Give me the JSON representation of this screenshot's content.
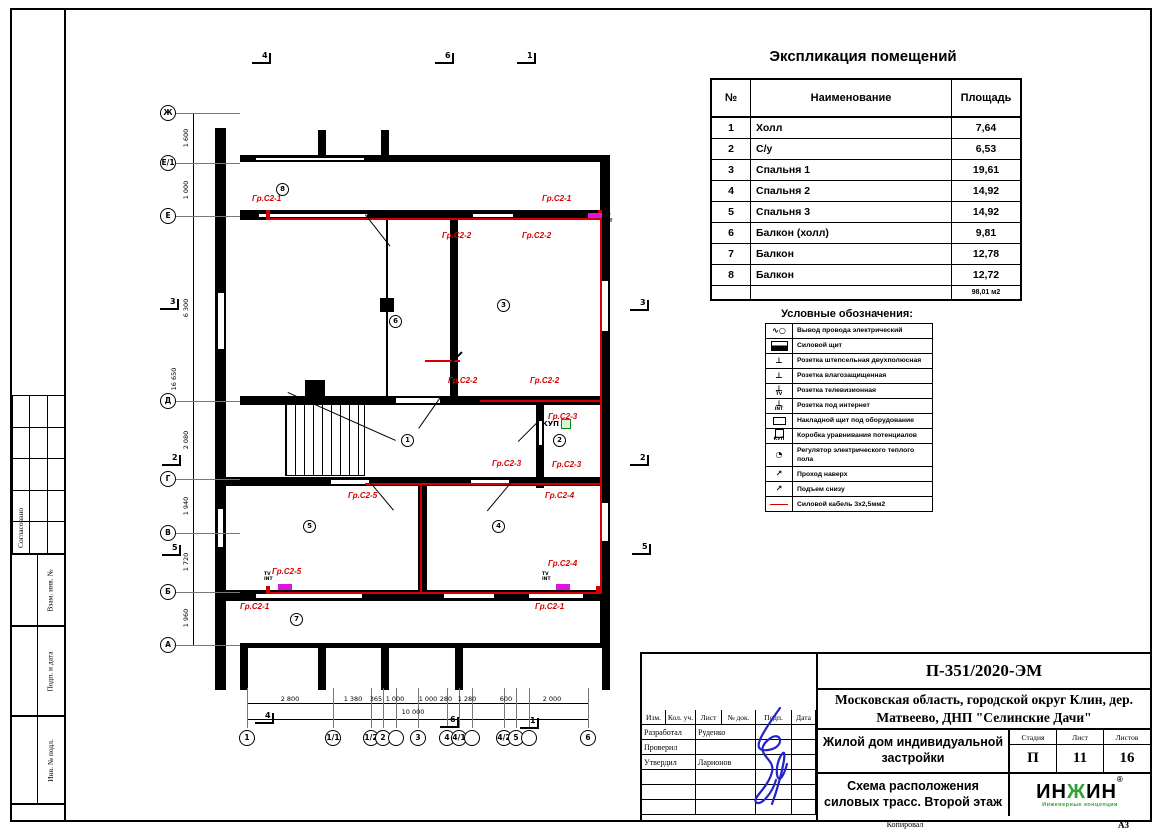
{
  "frame": {
    "copied": "Копировал",
    "format": "А3"
  },
  "left_margin": {
    "soglasovano": "Согласовано",
    "vzam": "Взам. инв. №",
    "podp_data": "Подп. и дата",
    "inv_podl": "Инв. № подл."
  },
  "explication": {
    "title": "Экспликация помещений",
    "columns": [
      "№",
      "Наименование",
      "Площадь"
    ],
    "rows": [
      [
        "1",
        "Холл",
        "7,64"
      ],
      [
        "2",
        "С/у",
        "6,53"
      ],
      [
        "3",
        "Спальня 1",
        "19,61"
      ],
      [
        "4",
        "Спальня 2",
        "14,92"
      ],
      [
        "5",
        "Спальня 3",
        "14,92"
      ],
      [
        "6",
        "Балкон (холл)",
        "9,81"
      ],
      [
        "7",
        "Балкон",
        "12,78"
      ],
      [
        "8",
        "Балкон",
        "12,72"
      ]
    ],
    "total": "98,01 м2"
  },
  "legend": {
    "title": "Условные обозначения:",
    "items": [
      {
        "icon": "wire-output-icon",
        "label": "Вывод провода электрический"
      },
      {
        "icon": "power-panel-icon",
        "label": "Силовой щит"
      },
      {
        "icon": "socket-double-icon",
        "label": "Розетка штепсельная двухполюсная"
      },
      {
        "icon": "socket-moisture-icon",
        "label": "Розетка влагозащищенная"
      },
      {
        "icon": "socket-tv-icon",
        "suffix": "TV",
        "label": "Розетка телевизионная"
      },
      {
        "icon": "socket-internet-icon",
        "suffix": "INT",
        "label": "Розетка под интернет"
      },
      {
        "icon": "surface-panel-icon",
        "label": "Накладной щит под оборудование"
      },
      {
        "icon": "kup-box-icon",
        "suffix": "КУП",
        "label": "Коробка уравнивания потенциалов"
      },
      {
        "icon": "floor-regulator-icon",
        "label": "Регулятор электрического теплого пола"
      },
      {
        "icon": "pass-up-icon",
        "label": "Проход наверх"
      },
      {
        "icon": "rise-below-icon",
        "label": "Подъем снизу"
      },
      {
        "icon": "power-cable-icon",
        "label": "Силовой кабель 3х2,5мм2"
      }
    ]
  },
  "titleblock": {
    "doc_number": "П-351/2020-ЭМ",
    "address": "Московская область, городской округ Клин, дер. Матвеево, ДНП \"Селинские Дачи\"",
    "object": "Жилой дом индивидуальной застройки",
    "sheet_title": "Схема расположения силовых трасс. Второй этаж",
    "cols": [
      "Изм.",
      "Кол. уч.",
      "Лист",
      "№ док.",
      "Подп.",
      "Дата"
    ],
    "roles": [
      {
        "role": "Разработал",
        "name": "Руденко"
      },
      {
        "role": "Проверил",
        "name": ""
      },
      {
        "role": "Утвердил",
        "name": "Ларионов"
      }
    ],
    "stage_label": "Стадия",
    "sheet_label": "Лист",
    "sheets_label": "Листов",
    "stage": "П",
    "sheet": "11",
    "sheets": "16",
    "logo": {
      "t1": "ИН",
      "t2": "Ж",
      "t3": "ИН",
      "reg": "®",
      "tagline": "Инженерные концепции"
    }
  },
  "plan": {
    "kup_label": "КУП",
    "tv_label": "TV",
    "int_label": "INT",
    "axes_left": [
      {
        "label": "Ж",
        "y": 73
      },
      {
        "label": "Е/1",
        "y": 123
      },
      {
        "label": "Е",
        "y": 176
      },
      {
        "label": "Д",
        "y": 361
      },
      {
        "label": "Г",
        "y": 439
      },
      {
        "label": "В",
        "y": 493
      },
      {
        "label": "Б",
        "y": 552
      },
      {
        "label": "А",
        "y": 605
      }
    ],
    "axes_bottom": [
      {
        "label": "1",
        "x": 107
      },
      {
        "label": "1/1",
        "x": 193
      },
      {
        "label": "1/2",
        "x": 231
      },
      {
        "label": "2",
        "x": 243
      },
      {
        "label": "",
        "x": 256
      },
      {
        "label": "3",
        "x": 278
      },
      {
        "label": "4",
        "x": 307
      },
      {
        "label": "4/1",
        "x": 319
      },
      {
        "label": "",
        "x": 332
      },
      {
        "label": "4/2",
        "x": 364
      },
      {
        "label": "5",
        "x": 376
      },
      {
        "label": "",
        "x": 389
      },
      {
        "label": "6",
        "x": 448
      }
    ],
    "dims_left": [
      {
        "t": "1 600",
        "y": 98
      },
      {
        "t": "1 000",
        "y": 150
      },
      {
        "t": "6 300",
        "y": 268
      },
      {
        "t": "2 080",
        "y": 400
      },
      {
        "t": "1 940",
        "y": 466
      },
      {
        "t": "1 720",
        "y": 522
      },
      {
        "t": "1 960",
        "y": 578
      },
      {
        "t": "16 650",
        "y": 339,
        "o": 1
      }
    ],
    "dims_bottom": [
      {
        "t": "2 800",
        "x": 150
      },
      {
        "t": "1 380",
        "x": 213
      },
      {
        "t": "365",
        "x": 236
      },
      {
        "t": "1 000",
        "x": 255
      },
      {
        "t": "1 000",
        "x": 288
      },
      {
        "t": "280",
        "x": 306
      },
      {
        "t": "1 280",
        "x": 327
      },
      {
        "t": "600",
        "x": 366
      },
      {
        "t": "2 000",
        "x": 412
      },
      {
        "t": "10 000",
        "x": 273,
        "y": 668,
        "o": 1
      }
    ],
    "group_labels": [
      {
        "t": "Гр.С2-1",
        "x": 112,
        "y": 155
      },
      {
        "t": "Гр.С2-1",
        "x": 402,
        "y": 155
      },
      {
        "t": "Гр.С2-2",
        "x": 302,
        "y": 192
      },
      {
        "t": "Гр.С2-2",
        "x": 382,
        "y": 192
      },
      {
        "t": "Гр.С2-2",
        "x": 308,
        "y": 337
      },
      {
        "t": "Гр.С2-2",
        "x": 390,
        "y": 337
      },
      {
        "t": "Гр.С2-3",
        "x": 408,
        "y": 373
      },
      {
        "t": "Гр.С2-3",
        "x": 352,
        "y": 420
      },
      {
        "t": "Гр.С2-3",
        "x": 412,
        "y": 421
      },
      {
        "t": "Гр.С2-4",
        "x": 405,
        "y": 452
      },
      {
        "t": "Гр.С2-4",
        "x": 408,
        "y": 520
      },
      {
        "t": "Гр.С2-5",
        "x": 208,
        "y": 452
      },
      {
        "t": "Гр.С2-5",
        "x": 132,
        "y": 528
      },
      {
        "t": "Гр.С2-1",
        "x": 100,
        "y": 563
      },
      {
        "t": "Гр.С2-1",
        "x": 395,
        "y": 563
      }
    ],
    "rooms": [
      {
        "n": "8",
        "x": 136,
        "y": 143
      },
      {
        "n": "6",
        "x": 249,
        "y": 275
      },
      {
        "n": "3",
        "x": 357,
        "y": 259
      },
      {
        "n": "1",
        "x": 261,
        "y": 394
      },
      {
        "n": "2",
        "x": 413,
        "y": 394
      },
      {
        "n": "5",
        "x": 163,
        "y": 480
      },
      {
        "n": "4",
        "x": 352,
        "y": 480
      },
      {
        "n": "7",
        "x": 150,
        "y": 573
      }
    ],
    "section_markers": [
      {
        "t": "4",
        "x": 112,
        "y": 12
      },
      {
        "t": "6",
        "x": 295,
        "y": 12
      },
      {
        "t": "1",
        "x": 377,
        "y": 12
      },
      {
        "t": "4",
        "x": 115,
        "y": 672
      },
      {
        "t": "6",
        "x": 300,
        "y": 676
      },
      {
        "t": "1",
        "x": 380,
        "y": 677
      },
      {
        "t": "3",
        "x": 20,
        "y": 258
      },
      {
        "t": "2",
        "x": 22,
        "y": 414
      },
      {
        "t": "5",
        "x": 22,
        "y": 504
      },
      {
        "t": "3",
        "x": 490,
        "y": 259
      },
      {
        "t": "2",
        "x": 490,
        "y": 414
      },
      {
        "t": "5",
        "x": 492,
        "y": 503
      }
    ]
  }
}
